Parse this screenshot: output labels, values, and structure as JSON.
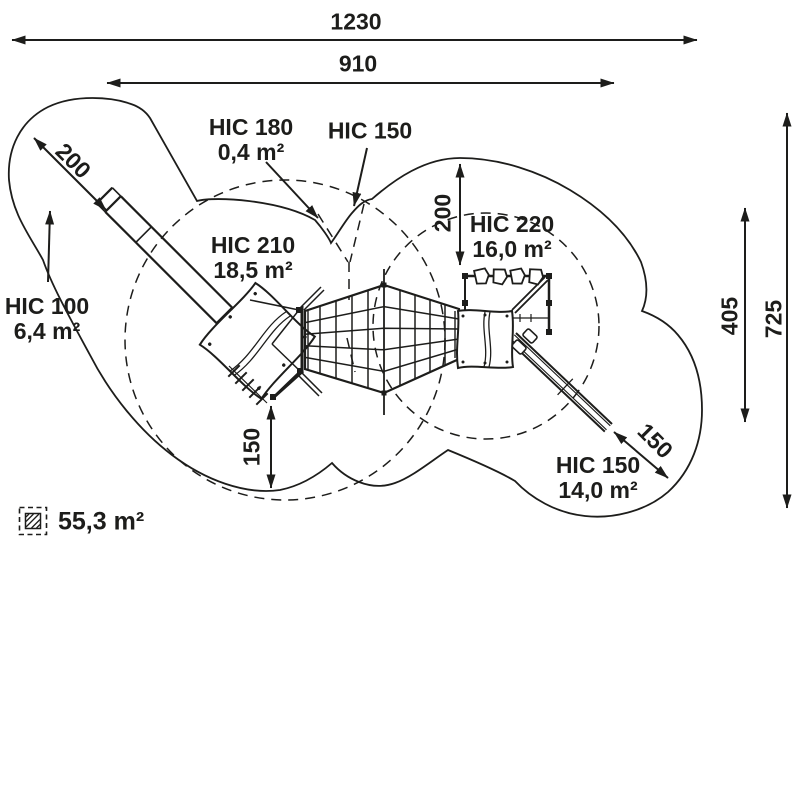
{
  "diagram": {
    "type": "playground-safety-zone-plan",
    "colors": {
      "line": "#1d1d1b",
      "background": "#ffffff"
    },
    "dimensions": {
      "total_width": "1230",
      "inner_width": "910",
      "slide_zone": "200",
      "top_zone": "200",
      "bottom_zone": "150",
      "slide_right_zone": "150",
      "inner_height": "405",
      "total_height": "725"
    },
    "zones": {
      "hic100": {
        "name": "HIC 100",
        "area": "6,4 m²"
      },
      "hic180": {
        "name": "HIC 180",
        "area": "0,4 m²"
      },
      "hic150_top": {
        "name": "HIC 150"
      },
      "hic210": {
        "name": "HIC 210",
        "area": "18,5 m²"
      },
      "hic220": {
        "name": "HIC 220",
        "area": "16,0 m²"
      },
      "hic150_bottom": {
        "name": "HIC 150",
        "area": "14,0 m²"
      }
    },
    "legend": {
      "total_area": "55,3 m²"
    }
  }
}
